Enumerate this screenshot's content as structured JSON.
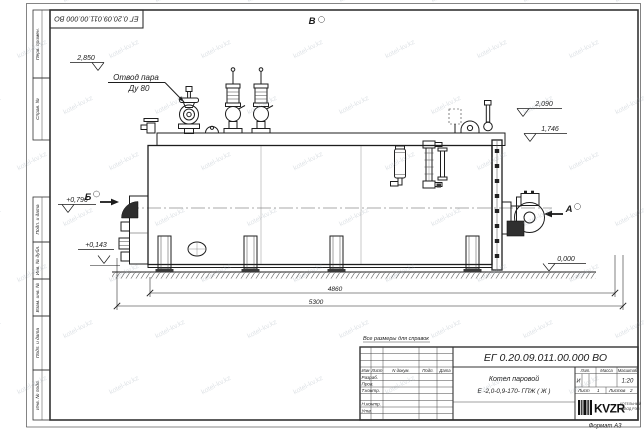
{
  "watermark": {
    "text": "kotel-kv.kz"
  },
  "sheet": {
    "top_stamp": "ЕГ 0.20.09.011.00.000  ВО",
    "reference_note": "Все размеры для справок",
    "format_note": "Формат  А3"
  },
  "margin": {
    "top": [
      "Перв. примен.",
      "Справ. №"
    ],
    "bottom": [
      "Подп. и дата",
      "Инв. № дубл.",
      "Взам. инв. №",
      "Подп. и дата",
      "Инв. № подл."
    ]
  },
  "title_block": {
    "doc_number": "ЕГ 0.20.09.011.00.000  ВО",
    "product_line1": "Котел паровой",
    "product_line2": "Е -2,0-0,9-170- ГПЖ ( Ж )",
    "columns": [
      "Изм",
      "Лист",
      "N докум.",
      "Подп.",
      "Дата"
    ],
    "roles": [
      "Разраб.",
      "Пров.",
      "Т.контр.",
      "Н.контр.",
      "Утв."
    ],
    "lit_header": "Лит.",
    "mass_header": "Масса",
    "scale_header": "Масштаб",
    "lit_value": "И",
    "scale_value": "1:20",
    "sheet_label": "Лист",
    "sheet_value": "1",
    "sheets_label": "Листов",
    "sheets_value": "2",
    "logo_text": "KVZR",
    "logo_caption1": "КОТЕЛЬНЫЙ",
    "logo_caption2": "ЗАВОД РЭП"
  },
  "drawing": {
    "steam_note1": "Отвод пара",
    "steam_note2": "Ду 80",
    "view_top": "В",
    "view_left": "Б",
    "view_right": "А",
    "elevations": {
      "e2850": "2,850",
      "e2090": "2,090",
      "e1746": "1,746",
      "e0796": "+0,796",
      "e0143": "+0,143",
      "e0000": "0,000"
    },
    "dims": {
      "length_boiler": "4860",
      "length_overall": "5300"
    }
  }
}
